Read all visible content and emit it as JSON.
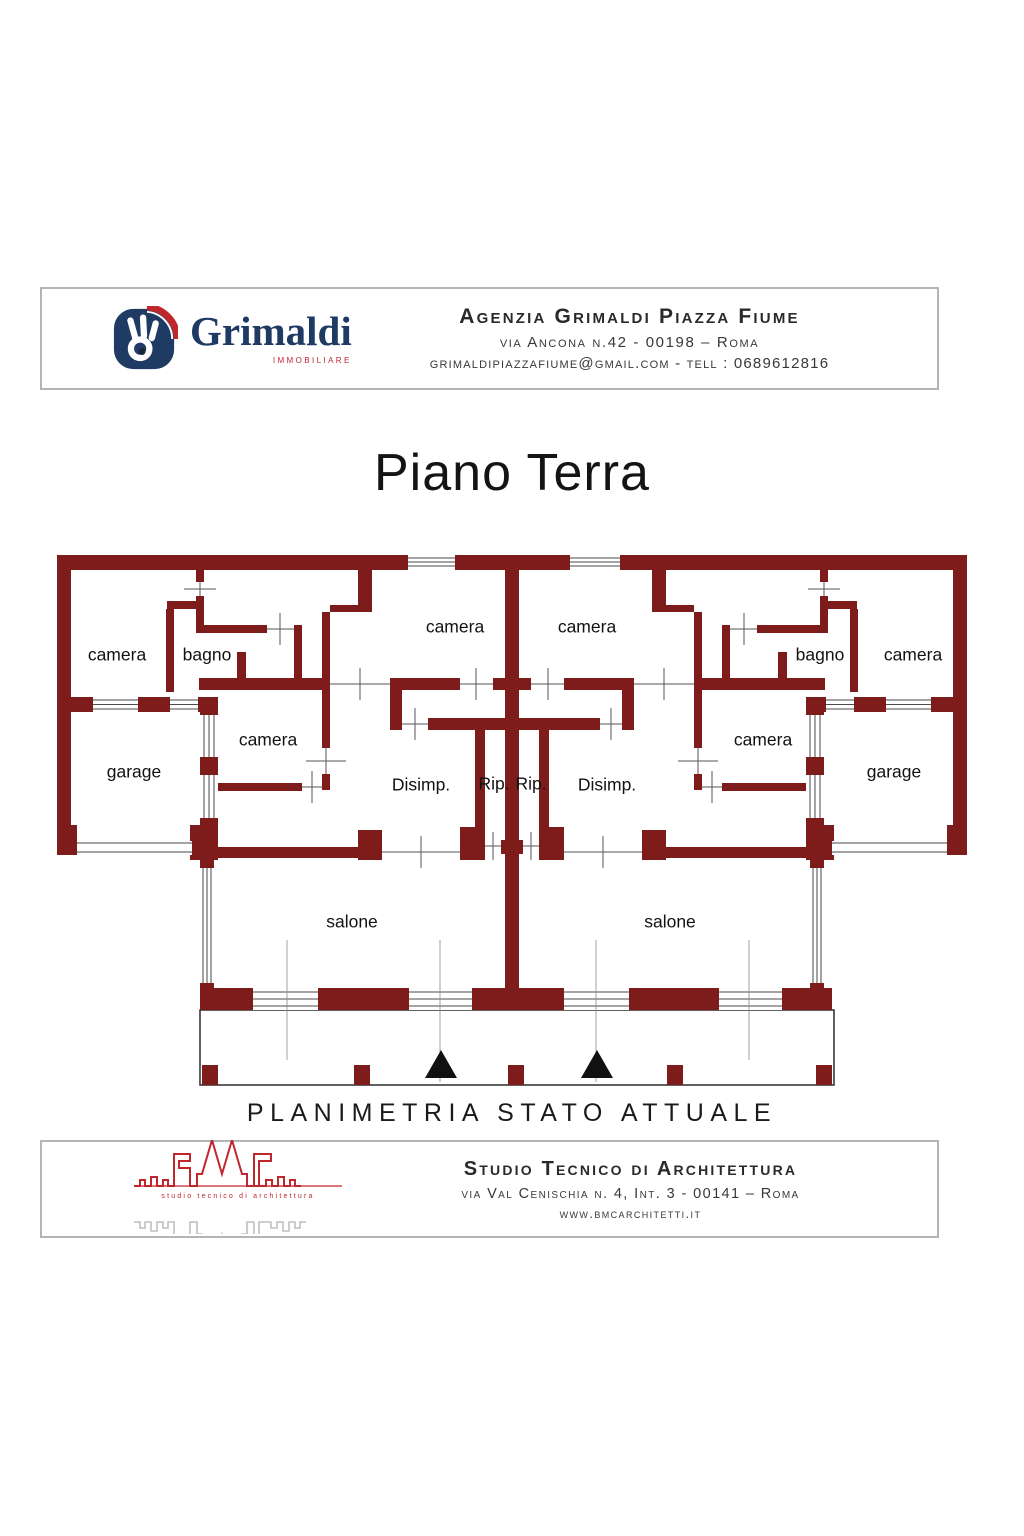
{
  "header": {
    "logo": {
      "brand": "Grimaldi",
      "sub": "immobiliare"
    },
    "line1": "Agenzia Grimaldi Piazza Fiume",
    "line2": "via Ancona n.42  - 00198 – Roma",
    "line3": "grimaldipiazzafiume@gmail.com - tell : 0689612816"
  },
  "title": "Piano Terra",
  "plan": {
    "labels": [
      {
        "text": "camera",
        "x": 117,
        "y": 655
      },
      {
        "text": "bagno",
        "x": 207,
        "y": 655
      },
      {
        "text": "camera",
        "x": 455,
        "y": 627
      },
      {
        "text": "camera",
        "x": 587,
        "y": 627
      },
      {
        "text": "bagno",
        "x": 820,
        "y": 655
      },
      {
        "text": "camera",
        "x": 913,
        "y": 655
      },
      {
        "text": "camera",
        "x": 268,
        "y": 740
      },
      {
        "text": "camera",
        "x": 763,
        "y": 740
      },
      {
        "text": "garage",
        "x": 134,
        "y": 772
      },
      {
        "text": "garage",
        "x": 894,
        "y": 772
      },
      {
        "text": "Disimp.",
        "x": 421,
        "y": 785
      },
      {
        "text": "Rip.",
        "x": 494,
        "y": 784
      },
      {
        "text": "Rip.",
        "x": 531,
        "y": 784
      },
      {
        "text": "Disimp.",
        "x": 607,
        "y": 785
      },
      {
        "text": "salone",
        "x": 352,
        "y": 922
      },
      {
        "text": "salone",
        "x": 670,
        "y": 922
      }
    ]
  },
  "caption": "PLANIMETRIA STATO ATTUALE",
  "footer": {
    "logo": {
      "brand": "BMC",
      "caption": "studio tecnico di architettura"
    },
    "line1": "Studio Tecnico di Architettura",
    "line2": "via Val Cenischia n. 4, Int. 3 - 00141 – Roma",
    "line3": "www.bmcarchitetti.it"
  },
  "colors": {
    "wall": "#7E1B1B",
    "brand_navy": "#1F3A63",
    "brand_red": "#C0272D"
  }
}
